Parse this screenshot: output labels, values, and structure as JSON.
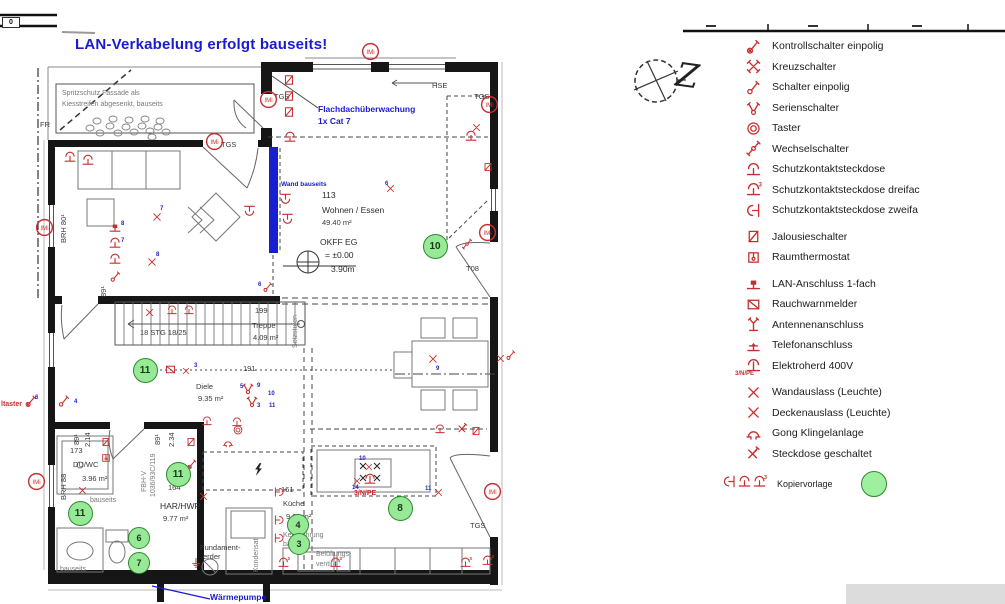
{
  "title": "LAN-Verkabelung erfolgt bauseits!",
  "scale_bar": {
    "zero": "0"
  },
  "compass": {
    "letter": "Z"
  },
  "colors": {
    "red": "#c62f2f",
    "blue": "#1a1ad1",
    "green": "#97e897",
    "wall": "#161616",
    "blue_wall": "#1620cf"
  },
  "plan": {
    "imi_text": "IMi",
    "labels": [
      {
        "t": "Spritzschutz Fassade als",
        "x": 62,
        "y": 90,
        "c": "g"
      },
      {
        "t": "Kiesstreifen abgesenkt, bauseits",
        "x": 62,
        "y": 101,
        "c": "g"
      },
      {
        "t": "FR",
        "x": 40,
        "y": 121,
        "c": "b"
      },
      {
        "t": "TGS",
        "x": 221,
        "y": 141,
        "c": "b"
      },
      {
        "t": "TGS",
        "x": 274,
        "y": 93,
        "c": "b"
      },
      {
        "t": "HSE",
        "x": 432,
        "y": 82,
        "c": "b"
      },
      {
        "t": "TGS",
        "x": 474,
        "y": 93,
        "c": "b"
      },
      {
        "t": "T08",
        "x": 466,
        "y": 265,
        "c": "b"
      },
      {
        "t": "TGS",
        "x": 470,
        "y": 522,
        "c": "b"
      },
      {
        "t": "113",
        "x": 322,
        "y": 191,
        "c": "b8"
      },
      {
        "t": "Wohnen / Essen",
        "x": 322,
        "y": 206,
        "c": "b8"
      },
      {
        "t": "49.40 m²",
        "x": 322,
        "y": 219,
        "c": "b"
      },
      {
        "t": "OKFF EG",
        "x": 320,
        "y": 238,
        "c": "b8"
      },
      {
        "t": "= ±0.00",
        "x": 325,
        "y": 251,
        "c": "b8"
      },
      {
        "t": "3.90m",
        "x": 331,
        "y": 265,
        "c": "b8"
      },
      {
        "t": "199",
        "x": 255,
        "y": 307,
        "c": "b"
      },
      {
        "t": "Treppe",
        "x": 252,
        "y": 322,
        "c": "b"
      },
      {
        "t": "4.09 m²",
        "x": 253,
        "y": 334,
        "c": "b"
      },
      {
        "t": "18 STG 18/25",
        "x": 140,
        "y": 329,
        "c": "b"
      },
      {
        "t": "Setzstufen",
        "x": 292,
        "y": 348,
        "c": "g rot"
      },
      {
        "t": "191",
        "x": 243,
        "y": 365,
        "c": "b"
      },
      {
        "t": "Diele",
        "x": 196,
        "y": 383,
        "c": "b"
      },
      {
        "t": "9.35 m²",
        "x": 198,
        "y": 395,
        "c": "b"
      },
      {
        "t": "173",
        "x": 70,
        "y": 447,
        "c": "b"
      },
      {
        "t": "DU/WC",
        "x": 73,
        "y": 461,
        "c": "b"
      },
      {
        "t": "3.96 m²",
        "x": 82,
        "y": 475,
        "c": "b"
      },
      {
        "t": "164",
        "x": 168,
        "y": 484,
        "c": "b"
      },
      {
        "t": "HAR/HWR",
        "x": 160,
        "y": 502,
        "c": "b8"
      },
      {
        "t": "9.77 m²",
        "x": 163,
        "y": 515,
        "c": "b"
      },
      {
        "t": "161",
        "x": 281,
        "y": 486,
        "c": "b"
      },
      {
        "t": "Küche",
        "x": 283,
        "y": 500,
        "c": "b"
      },
      {
        "t": "9.62 m²",
        "x": 286,
        "y": 513,
        "c": "b"
      },
      {
        "t": "Kernbohrung",
        "x": 283,
        "y": 532,
        "c": "g"
      },
      {
        "t": "bauseits",
        "x": 283,
        "y": 541,
        "c": "g"
      },
      {
        "t": "Belüftungs-",
        "x": 316,
        "y": 551,
        "c": "g"
      },
      {
        "t": "ventil",
        "x": 316,
        "y": 561,
        "c": "g"
      },
      {
        "t": "Fundament-",
        "x": 200,
        "y": 544,
        "c": "b"
      },
      {
        "t": "erder",
        "x": 203,
        "y": 553,
        "c": "b"
      },
      {
        "t": "Kondensat",
        "x": 253,
        "y": 572,
        "c": "g rot"
      },
      {
        "t": "bauseits",
        "x": 90,
        "y": 497,
        "c": "g"
      },
      {
        "t": "bauseits",
        "x": 60,
        "y": 566,
        "c": "g"
      },
      {
        "t": "BRH 80¹",
        "x": 60,
        "y": 243,
        "c": "b rot"
      },
      {
        "t": "BRH 88",
        "x": 60,
        "y": 500,
        "c": "b rot"
      },
      {
        "t": "89¹",
        "x": 100,
        "y": 297,
        "c": "b rot"
      },
      {
        "t": "89¹",
        "x": 73,
        "y": 445,
        "c": "b rot"
      },
      {
        "t": "2.14",
        "x": 84,
        "y": 447,
        "c": "b rot"
      },
      {
        "t": "89¹",
        "x": 154,
        "y": 445,
        "c": "b rot"
      },
      {
        "t": "2.34",
        "x": 168,
        "y": 447,
        "c": "b rot"
      },
      {
        "t": "FBH-V",
        "x": 141,
        "y": 492,
        "c": "g rot"
      },
      {
        "t": "1036/93C/119",
        "x": 150,
        "y": 497,
        "c": "g rot"
      },
      {
        "t": "ltaster",
        "x": 1,
        "y": 401,
        "c": "redt"
      },
      {
        "t": "3/N/PE",
        "x": 354,
        "y": 490,
        "c": "redt"
      },
      {
        "t": "Flachdachüberwachung",
        "x": 318,
        "y": 105,
        "c": "blueb"
      },
      {
        "t": "1x Cat 7",
        "x": 318,
        "y": 117,
        "c": "blueb"
      },
      {
        "t": "Wand bauseits",
        "x": 281,
        "y": 181,
        "c": "blues"
      },
      {
        "t": "Wärmepumpe",
        "x": 210,
        "y": 593,
        "c": "blueb"
      }
    ],
    "symbols": [
      {
        "t": "box",
        "x": 289,
        "y": 80
      },
      {
        "t": "box",
        "x": 289,
        "y": 96
      },
      {
        "t": "box",
        "x": 289,
        "y": 112
      },
      {
        "t": "imi",
        "x": 268,
        "y": 99
      },
      {
        "t": "imi",
        "x": 214,
        "y": 141
      },
      {
        "t": "imi",
        "x": 370,
        "y": 51
      },
      {
        "t": "imi",
        "x": 489,
        "y": 104
      },
      {
        "t": "imi",
        "x": 44,
        "y": 227
      },
      {
        "t": "imi",
        "x": 36,
        "y": 481
      },
      {
        "t": "imi",
        "x": 487,
        "y": 232
      },
      {
        "t": "imi",
        "x": 492,
        "y": 491
      },
      {
        "t": "socket",
        "x": 290,
        "y": 137
      },
      {
        "t": "socket",
        "x": 471,
        "y": 136
      },
      {
        "t": "xmark",
        "x": 476,
        "y": 125,
        "s": 11
      },
      {
        "t": "box",
        "x": 488,
        "y": 166,
        "s": 12
      },
      {
        "t": "socket",
        "x": 70,
        "y": 157
      },
      {
        "t": "socket",
        "x": 88,
        "y": 160
      },
      {
        "t": "lan",
        "x": 115,
        "y": 227
      },
      {
        "t": "socket",
        "x": 115,
        "y": 243
      },
      {
        "t": "socket",
        "x": 115,
        "y": 259
      },
      {
        "t": "schalter",
        "x": 115,
        "y": 276,
        "s": 13
      },
      {
        "t": "xmark",
        "x": 157,
        "y": 216,
        "s": 12
      },
      {
        "t": "xmark",
        "x": 152,
        "y": 261,
        "s": 12
      },
      {
        "t": "xmark",
        "x": 390,
        "y": 186,
        "s": 11
      },
      {
        "t": "socket2",
        "x": 252,
        "y": 208,
        "r": -90
      },
      {
        "t": "socket2",
        "x": 288,
        "y": 196,
        "r": -90
      },
      {
        "t": "socket2",
        "x": 290,
        "y": 216,
        "r": -90
      },
      {
        "t": "schalter",
        "x": 268,
        "y": 286,
        "s": 12
      },
      {
        "t": "xmark",
        "x": 149,
        "y": 310,
        "s": 11
      },
      {
        "t": "socket",
        "x": 172,
        "y": 309,
        "s": 12
      },
      {
        "t": "socket",
        "x": 189,
        "y": 309,
        "s": 12
      },
      {
        "t": "rwm",
        "x": 170,
        "y": 369,
        "s": 13
      },
      {
        "t": "xmark",
        "x": 186,
        "y": 368,
        "s": 10
      },
      {
        "t": "serien",
        "x": 248,
        "y": 388
      },
      {
        "t": "serien",
        "x": 252,
        "y": 401
      },
      {
        "t": "kontroll",
        "x": 31,
        "y": 401
      },
      {
        "t": "schalter",
        "x": 64,
        "y": 401
      },
      {
        "t": "xmark",
        "x": 433,
        "y": 358,
        "s": 12
      },
      {
        "t": "xmark",
        "x": 500,
        "y": 356,
        "s": 11
      },
      {
        "t": "schalter",
        "x": 511,
        "y": 354,
        "s": 12
      },
      {
        "t": "wechsel",
        "x": 467,
        "y": 243,
        "s": 12
      },
      {
        "t": "xmark",
        "x": 82,
        "y": 488,
        "s": 11
      },
      {
        "t": "box",
        "x": 106,
        "y": 441,
        "s": 12
      },
      {
        "t": "thermostat",
        "x": 106,
        "y": 457,
        "s": 12
      },
      {
        "t": "socket",
        "x": 207,
        "y": 420,
        "s": 12
      },
      {
        "t": "socket",
        "x": 237,
        "y": 421,
        "s": 12
      },
      {
        "t": "taster",
        "x": 238,
        "y": 429,
        "s": 12
      },
      {
        "t": "gong",
        "x": 228,
        "y": 442,
        "s": 12
      },
      {
        "t": "box",
        "x": 191,
        "y": 441,
        "s": 12
      },
      {
        "t": "kontroll",
        "x": 192,
        "y": 463,
        "s": 12
      },
      {
        "t": "xmark",
        "x": 203,
        "y": 494,
        "s": 11
      },
      {
        "t": "socket",
        "x": 440,
        "y": 428,
        "s": 12
      },
      {
        "t": "geschaltet",
        "x": 462,
        "y": 428,
        "s": 13
      },
      {
        "t": "box",
        "x": 476,
        "y": 430,
        "s": 12
      },
      {
        "t": "herd",
        "x": 370,
        "y": 479
      },
      {
        "t": "xmark",
        "x": 369,
        "y": 464,
        "s": 10
      },
      {
        "t": "xmark",
        "x": 357,
        "y": 478,
        "s": 10
      },
      {
        "t": "xmark",
        "x": 438,
        "y": 490,
        "s": 11
      },
      {
        "t": "socket",
        "x": 277,
        "y": 489,
        "r": 90,
        "s": 12
      },
      {
        "t": "socket",
        "x": 277,
        "y": 517,
        "r": 90,
        "s": 12
      },
      {
        "t": "socket",
        "x": 277,
        "y": 535,
        "r": 90,
        "s": 12
      },
      {
        "t": "socket3",
        "x": 283,
        "y": 562,
        "s": 13
      },
      {
        "t": "socket3",
        "x": 335,
        "y": 562,
        "s": 13
      },
      {
        "t": "socket3",
        "x": 465,
        "y": 562,
        "s": 13
      },
      {
        "t": "socket3",
        "x": 487,
        "y": 560,
        "s": 13
      },
      {
        "t": "erder",
        "x": 196,
        "y": 562,
        "s": 12
      },
      {
        "t": "lightning",
        "x": 258,
        "y": 469,
        "s": 15
      }
    ],
    "ref_numbers": [
      {
        "t": "7",
        "x": 160,
        "y": 206
      },
      {
        "t": "8",
        "x": 156,
        "y": 252
      },
      {
        "t": "6",
        "x": 385,
        "y": 181
      },
      {
        "t": "9",
        "x": 436,
        "y": 366
      },
      {
        "t": "5",
        "x": 240,
        "y": 384
      },
      {
        "t": "9",
        "x": 257,
        "y": 383
      },
      {
        "t": "10",
        "x": 268,
        "y": 391
      },
      {
        "t": "3",
        "x": 257,
        "y": 403
      },
      {
        "t": "11",
        "x": 269,
        "y": 403
      },
      {
        "t": "3",
        "x": 194,
        "y": 363
      },
      {
        "t": "8",
        "x": 121,
        "y": 221
      },
      {
        "t": "7",
        "x": 121,
        "y": 238
      },
      {
        "t": "6",
        "x": 258,
        "y": 282
      },
      {
        "t": "6",
        "x": 35,
        "y": 395
      },
      {
        "t": "4",
        "x": 74,
        "y": 399
      },
      {
        "t": "10",
        "x": 359,
        "y": 456
      },
      {
        "t": "14",
        "x": 352,
        "y": 485
      },
      {
        "t": "11",
        "x": 425,
        "y": 486
      }
    ],
    "copy_markers": [
      {
        "n": "10",
        "x": 434,
        "y": 245,
        "d": 23
      },
      {
        "n": "11",
        "x": 144,
        "y": 369,
        "d": 23
      },
      {
        "n": "11",
        "x": 177,
        "y": 473,
        "d": 23
      },
      {
        "n": "11",
        "x": 79,
        "y": 512,
        "d": 23
      },
      {
        "n": "8",
        "x": 399,
        "y": 507,
        "d": 23
      },
      {
        "n": "6",
        "x": 138,
        "y": 537,
        "d": 20
      },
      {
        "n": "7",
        "x": 138,
        "y": 562,
        "d": 20
      },
      {
        "n": "4",
        "x": 297,
        "y": 524,
        "d": 20
      },
      {
        "n": "3",
        "x": 298,
        "y": 543,
        "d": 20
      }
    ]
  },
  "legend": {
    "items": [
      {
        "icon": "kontroll",
        "label": "Kontrollschalter einpolig"
      },
      {
        "icon": "kreuz",
        "label": "Kreuzschalter"
      },
      {
        "icon": "schalter",
        "label": "Schalter einpolig"
      },
      {
        "icon": "serien",
        "label": "Serienschalter"
      },
      {
        "icon": "taster",
        "label": "Taster"
      },
      {
        "icon": "wechsel",
        "label": "Wechselschalter"
      },
      {
        "icon": "socket",
        "label": "Schutzkontaktsteckdose"
      },
      {
        "icon": "socket3",
        "label": "Schutzkontaktsteckdose dreifac"
      },
      {
        "icon": "socket2",
        "label": "Schutzkontaktsteckdose zweifa",
        "gap": true
      },
      {
        "icon": "box",
        "label": "Jalousieschalter"
      },
      {
        "icon": "thermostat",
        "label": "Raumthermostat",
        "gap": true
      },
      {
        "icon": "lan",
        "label": "LAN-Anschluss 1-fach"
      },
      {
        "icon": "rwm",
        "label": "Rauchwarnmelder"
      },
      {
        "icon": "antenna",
        "label": "Antennenanschluss"
      },
      {
        "icon": "telefon",
        "label": "Telefonanschluss"
      },
      {
        "icon": "herd",
        "label": "Elektroherd 400V",
        "sub": "3/N/PE",
        "gap": true
      },
      {
        "icon": "xmark",
        "label": "Wandauslass (Leuchte)"
      },
      {
        "icon": "xmark",
        "label": "Deckenauslass (Leuchte)"
      },
      {
        "icon": "gong",
        "label": "Gong Klingelanlage"
      },
      {
        "icon": "geschaltet",
        "label": "Steckdose geschaltet"
      }
    ],
    "kopiervorlage": {
      "label": "Kopiervorlage"
    }
  }
}
